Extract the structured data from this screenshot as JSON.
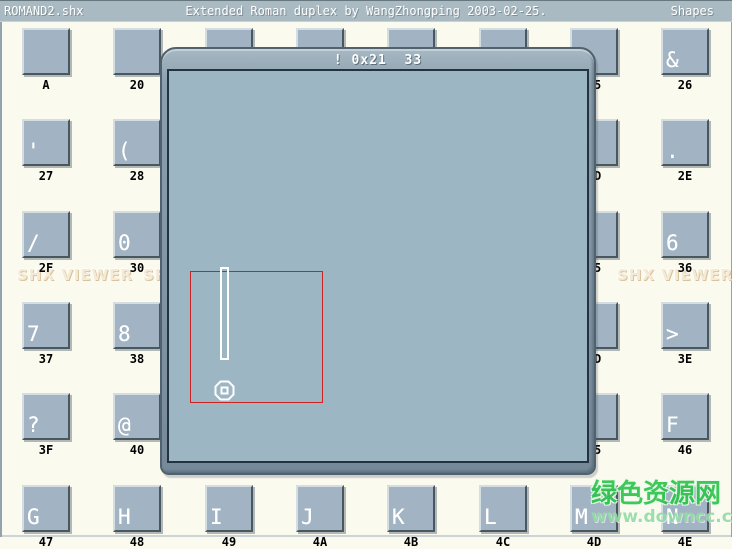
{
  "title_bar": {
    "file": "ROMAND2.shx",
    "description": "Extended Roman duplex by WangZhongping 2003-02-25.",
    "section": "Shapes"
  },
  "dialog": {
    "title": "! 0x21  33",
    "glyph_char": "!",
    "glyph_code_hex": "0x21",
    "glyph_code_dec": "33"
  },
  "watermark": {
    "shx_viewer": "SHX VIEWER",
    "site_name": "绿色资源网",
    "site_url": "www.downcc.com"
  },
  "colors": {
    "selection_red": "#cc2222",
    "glyph_white": "#ffffff",
    "tile_fill": "#a2b4c3",
    "canvas_fill": "#9cb6c4",
    "titlebar_fill": "#a9bac3",
    "background_cream": "#fafaef",
    "watermark_green": "#2fc44d"
  },
  "grid": {
    "rows": [
      [
        {
          "label": "A",
          "glyph": ""
        },
        {
          "label": "20",
          "glyph": ""
        },
        {
          "label": "21",
          "glyph": "!"
        },
        {
          "label": "22",
          "glyph": "\""
        },
        {
          "label": "23",
          "glyph": "#"
        },
        {
          "label": "24",
          "glyph": "$"
        },
        {
          "label": "25",
          "glyph": "%"
        },
        {
          "label": "26",
          "glyph": "&"
        }
      ],
      [
        {
          "label": "27",
          "glyph": "'"
        },
        {
          "label": "28",
          "glyph": "("
        },
        {
          "label": "29",
          "glyph": ")"
        },
        {
          "label": "2A",
          "glyph": "*"
        },
        {
          "label": "2B",
          "glyph": "+"
        },
        {
          "label": "2C",
          "glyph": ","
        },
        {
          "label": "2D",
          "glyph": "-"
        },
        {
          "label": "2E",
          "glyph": "."
        }
      ],
      [
        {
          "label": "2F",
          "glyph": "/"
        },
        {
          "label": "30",
          "glyph": "0"
        },
        {
          "label": "31",
          "glyph": "1"
        },
        {
          "label": "32",
          "glyph": "2"
        },
        {
          "label": "33",
          "glyph": "3"
        },
        {
          "label": "34",
          "glyph": "4"
        },
        {
          "label": "35",
          "glyph": "5"
        },
        {
          "label": "36",
          "glyph": "6"
        }
      ],
      [
        {
          "label": "37",
          "glyph": "7"
        },
        {
          "label": "38",
          "glyph": "8"
        },
        {
          "label": "39",
          "glyph": "9"
        },
        {
          "label": "3A",
          "glyph": ":"
        },
        {
          "label": "3B",
          "glyph": ";"
        },
        {
          "label": "3C",
          "glyph": "<"
        },
        {
          "label": "3D",
          "glyph": "="
        },
        {
          "label": "3E",
          "glyph": ">"
        }
      ],
      [
        {
          "label": "3F",
          "glyph": "?"
        },
        {
          "label": "40",
          "glyph": "@"
        },
        {
          "label": "41",
          "glyph": "A"
        },
        {
          "label": "42",
          "glyph": "B"
        },
        {
          "label": "43",
          "glyph": "C"
        },
        {
          "label": "44",
          "glyph": "D"
        },
        {
          "label": "45",
          "glyph": "E"
        },
        {
          "label": "46",
          "glyph": "F"
        }
      ],
      [
        {
          "label": "47",
          "glyph": "G"
        },
        {
          "label": "48",
          "glyph": "H"
        },
        {
          "label": "49",
          "glyph": "I"
        },
        {
          "label": "4A",
          "glyph": "J"
        },
        {
          "label": "4B",
          "glyph": "K"
        },
        {
          "label": "4C",
          "glyph": "L"
        },
        {
          "label": "4D",
          "glyph": "M"
        },
        {
          "label": "4E",
          "glyph": "N"
        }
      ]
    ]
  }
}
